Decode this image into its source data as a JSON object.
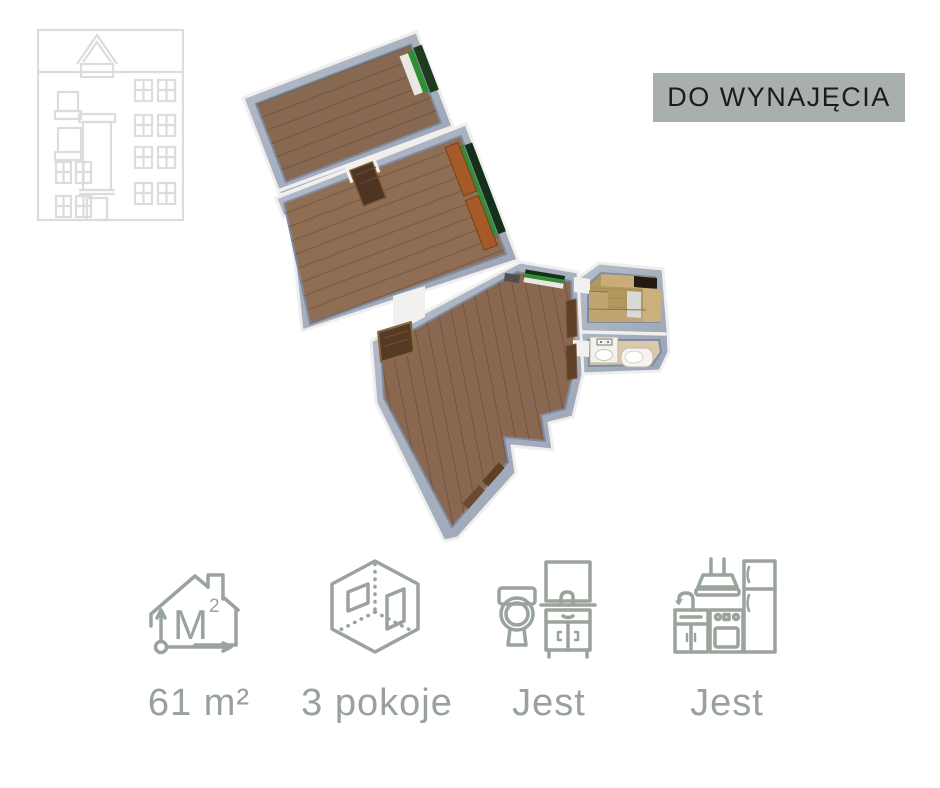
{
  "status_banner": {
    "label": "DO WYNAJĘCIA"
  },
  "features": [
    {
      "id": "area",
      "icon": "area-house-icon",
      "label": "61 m²"
    },
    {
      "id": "rooms",
      "icon": "rooms-cube-icon",
      "label": "3 pokoje"
    },
    {
      "id": "bathroom",
      "icon": "bathroom-icon",
      "label": "Jest"
    },
    {
      "id": "kitchen",
      "icon": "kitchen-icon",
      "label": "Jest"
    }
  ],
  "icons": {
    "area_label": "M",
    "area_sup": "2"
  },
  "colors": {
    "page_bg": "#ffffff",
    "banner_bg": "#a9b0ab",
    "banner_text": "#1b1b1b",
    "icon_gray_green": "#9aa39c",
    "label_gray_green": "#98a29b",
    "logo_gray": "#dcdcda",
    "wall_face_blue_gray": "#a6afbd",
    "wall_top_white": "#f1efed",
    "wood_floor_brown": "#8c6c52",
    "kitchen_floor_tan": "#b2975e",
    "bathroom_floor_beige": "#dbc9a9",
    "radiator_green": "#2f8f32",
    "door_brown": "#553a24",
    "sideboard_orange": "#a55a28"
  }
}
